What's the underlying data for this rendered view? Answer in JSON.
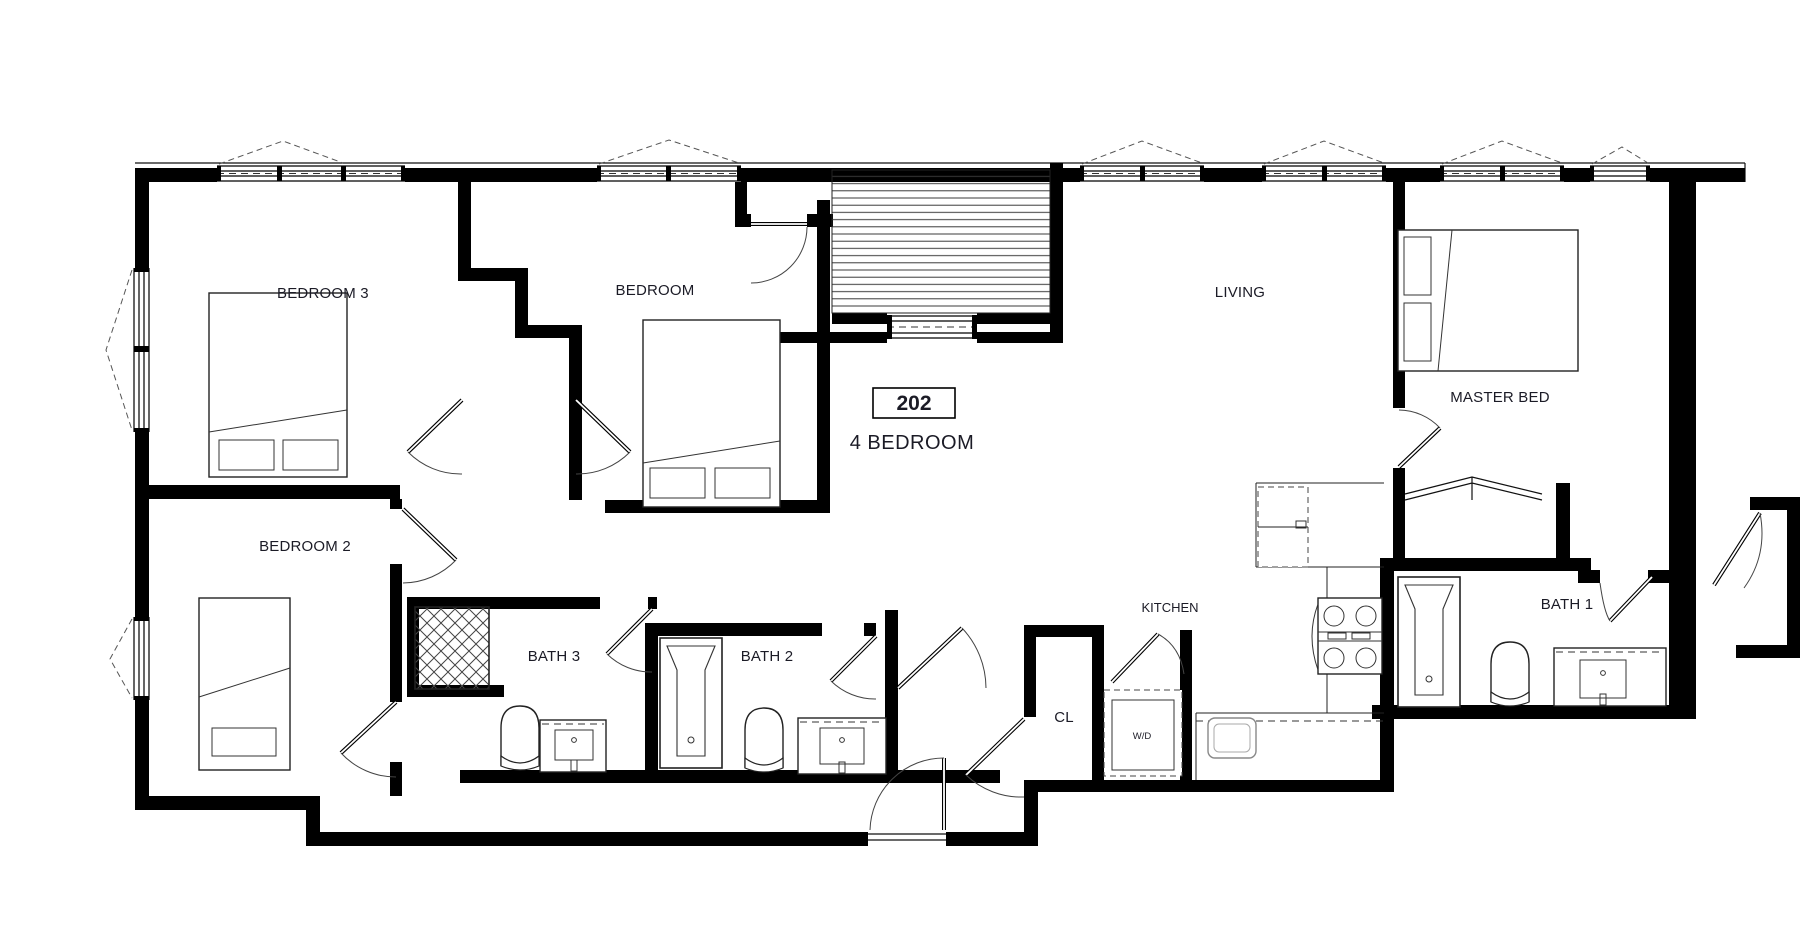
{
  "unit": {
    "number": "202",
    "type": "4 BEDROOM"
  },
  "rooms": [
    {
      "id": "bedroom3",
      "label": "BEDROOM 3"
    },
    {
      "id": "bedroom",
      "label": "BEDROOM"
    },
    {
      "id": "living",
      "label": "LIVING"
    },
    {
      "id": "master",
      "label": "MASTER BED"
    },
    {
      "id": "bedroom2",
      "label": "BEDROOM 2"
    },
    {
      "id": "bath3",
      "label": "BATH 3"
    },
    {
      "id": "bath2",
      "label": "BATH 2"
    },
    {
      "id": "bath1",
      "label": "BATH 1"
    },
    {
      "id": "kitchen",
      "label": "KITCHEN"
    },
    {
      "id": "closet",
      "label": "CL"
    },
    {
      "id": "laundry",
      "label": "W/D"
    }
  ],
  "colors": {
    "wall": "#000000",
    "text": "#1b1b26",
    "background": "#ffffff"
  }
}
